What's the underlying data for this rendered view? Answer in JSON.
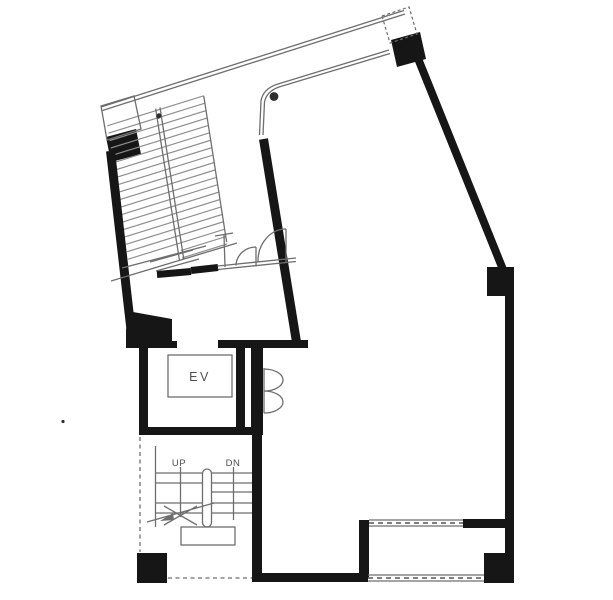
{
  "labels": {
    "elevator": "EV",
    "stairs_up": "UP",
    "stairs_down": "DN"
  },
  "colors": {
    "background": "#ffffff",
    "wall": "#161616",
    "thin_line": "#6e6e6e",
    "tread_line": "#8e8e8e",
    "label_text": "#4f4f4f",
    "dot": "#2e2e2e"
  }
}
